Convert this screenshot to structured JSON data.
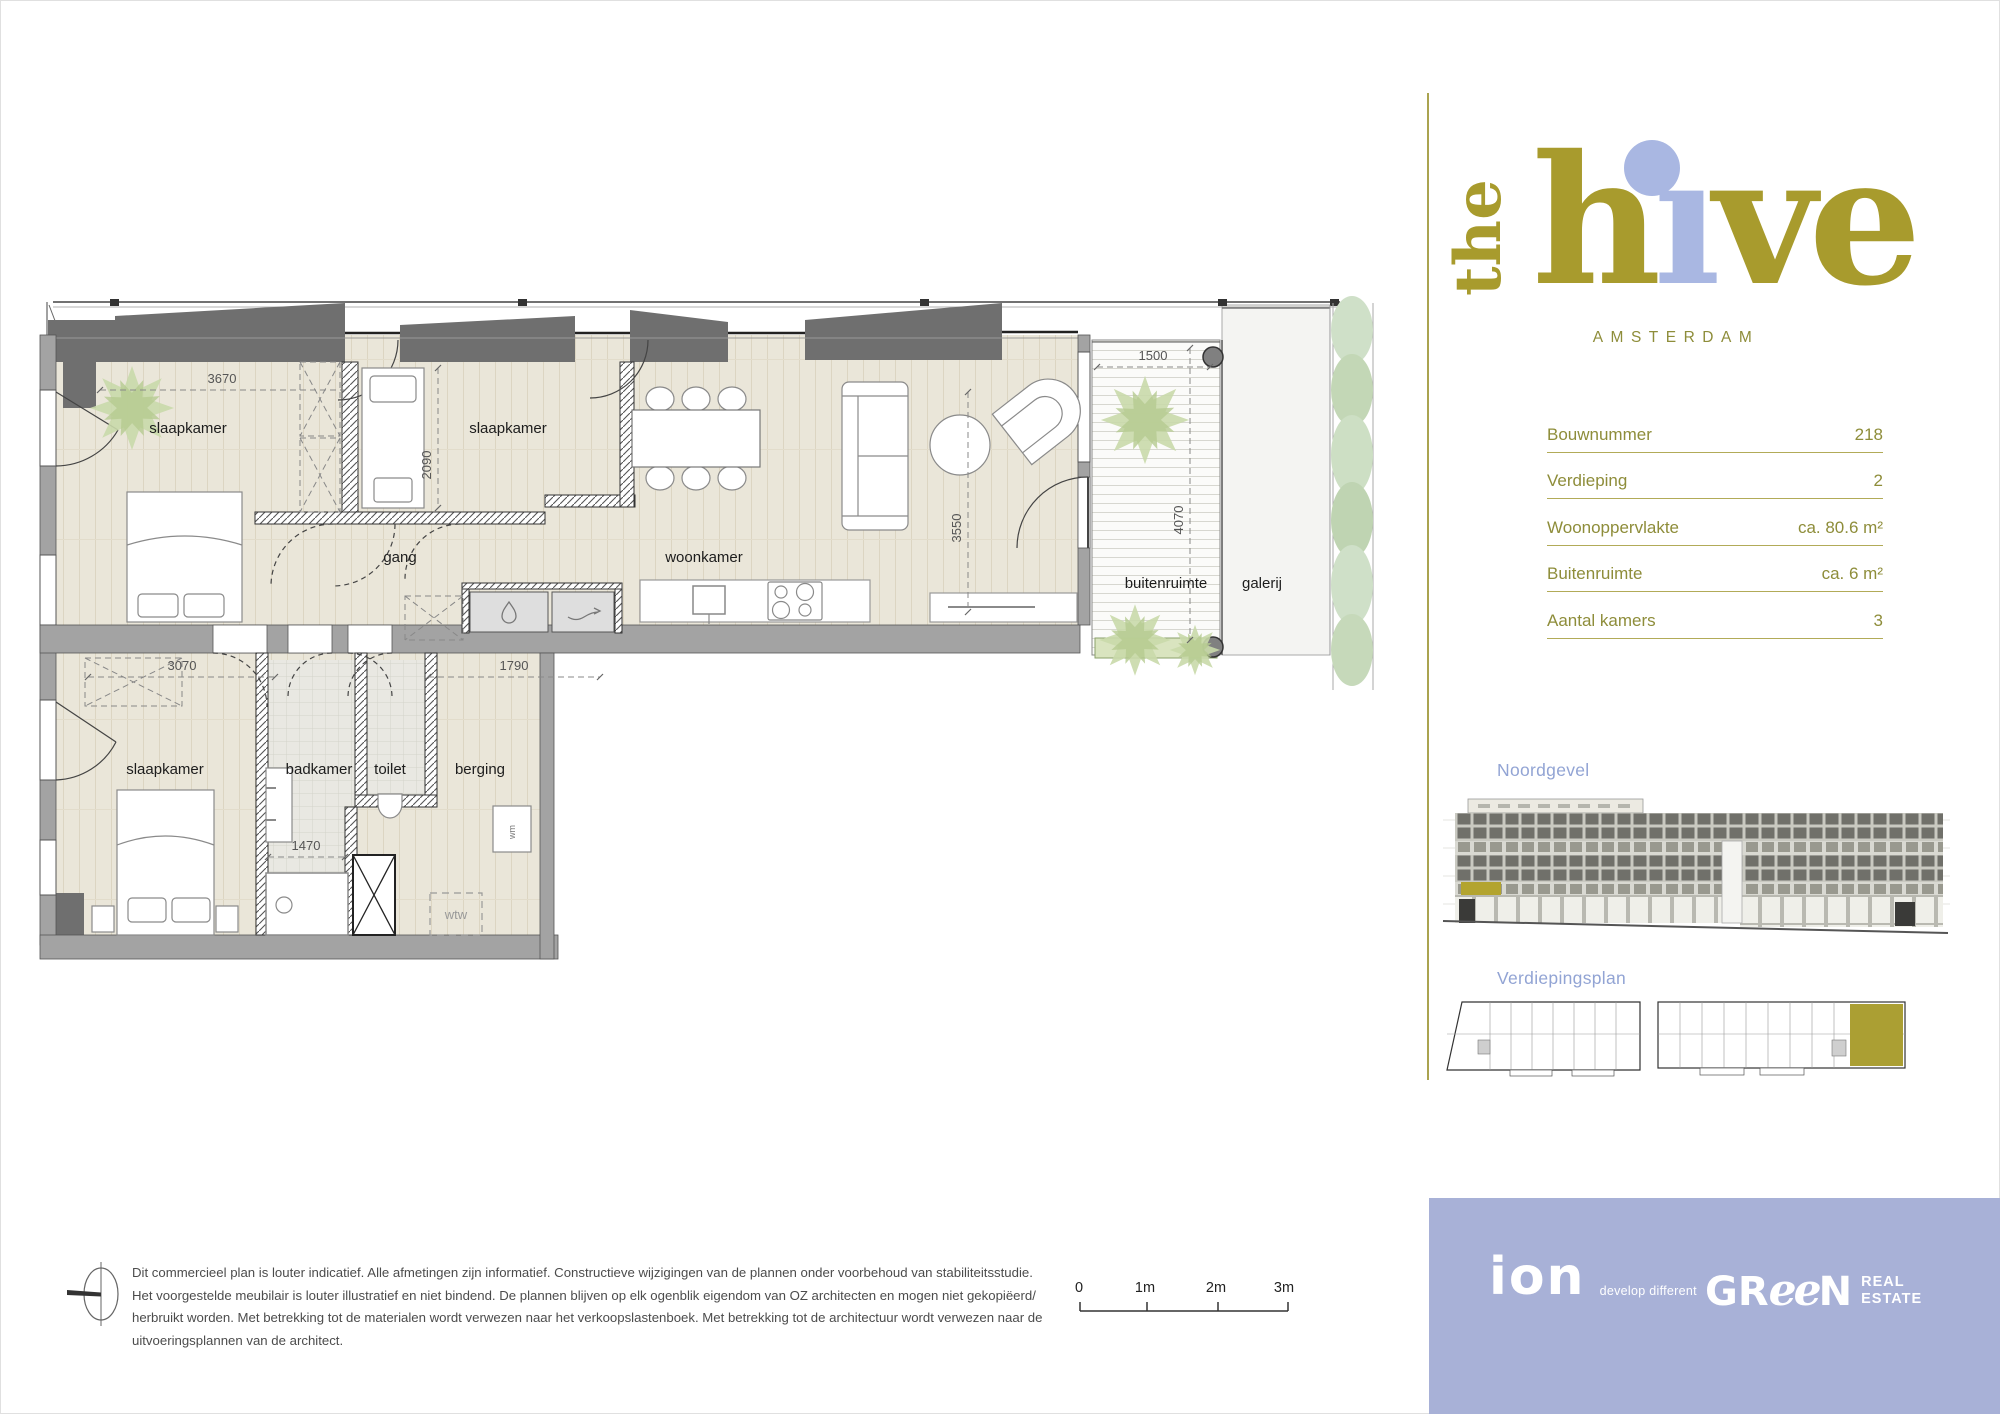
{
  "logo": {
    "the": "the",
    "h": "h",
    "i_dotless": "ı",
    "ve": "ve",
    "city": "AMSTERDAM"
  },
  "details": {
    "rows": [
      {
        "label": "Bouwnummer",
        "value": "218"
      },
      {
        "label": "Verdieping",
        "value": "2"
      },
      {
        "label": "Woonoppervlakte",
        "value": "ca. 80.6 m²"
      },
      {
        "label": "Buitenruimte",
        "value": "ca. 6 m²"
      },
      {
        "label": "Aantal kamers",
        "value": "3"
      }
    ]
  },
  "sections": {
    "elevation": "Noordgevel",
    "floor_overview": "Verdiepingsplan"
  },
  "plan": {
    "rooms": {
      "bedroom": "slaapkamer",
      "hallway": "gang",
      "living": "woonkamer",
      "bathroom": "badkamer",
      "toilet": "toilet",
      "storage": "berging",
      "outdoor": "buitenruimte",
      "gallery": "galerij"
    },
    "labels": {
      "wtw": "wtw",
      "wm": "wm"
    },
    "dimensions": {
      "bedroom1_width": "3670",
      "bedroom2_depth": "2090",
      "living_width": "3550",
      "balcony_width": "1500",
      "balcony_depth": "4070",
      "bedroom3_width": "3070",
      "storage_width": "1790",
      "bathroom_width": "1470"
    }
  },
  "scalebar": {
    "labels": [
      "0",
      "1m",
      "2m",
      "3m"
    ]
  },
  "disclaimer": {
    "lines": [
      "Dit commercieel plan is louter indicatief. Alle afmetingen zijn informatief. Constructieve wijzigingen van de plannen onder voorbehoud van stabiliteitsstudie.",
      "Het voorgestelde meubilair is louter illustratief en niet bindend. De plannen blijven op elk ogenblik eigendom van OZ architecten en mogen niet gekopiëerd/",
      "herbruikt worden. Met betrekking tot de materialen wordt verwezen naar het verkoopslastenboek. Met betrekking tot de architectuur wordt verwezen naar de",
      "uitvoeringsplannen van de architect."
    ]
  },
  "footer": {
    "ion": "ion",
    "tagline": "develop different",
    "green_gr": "GR",
    "green_ee": "ee",
    "green_n": "N",
    "real": "REAL",
    "estate": "ESTATE"
  },
  "colors": {
    "olive": "#a89b2d",
    "olive_text": "#8e8d3a",
    "periwinkle": "#a9b7e2",
    "label_blue": "#92a4d4",
    "footer_bg": "#a8b1d7",
    "floor_beige": "#eae6d9",
    "wall_gray": "#a3a3a3",
    "canopy_gray": "#6f6f6f",
    "highlight_olive": "#b3a42f"
  }
}
